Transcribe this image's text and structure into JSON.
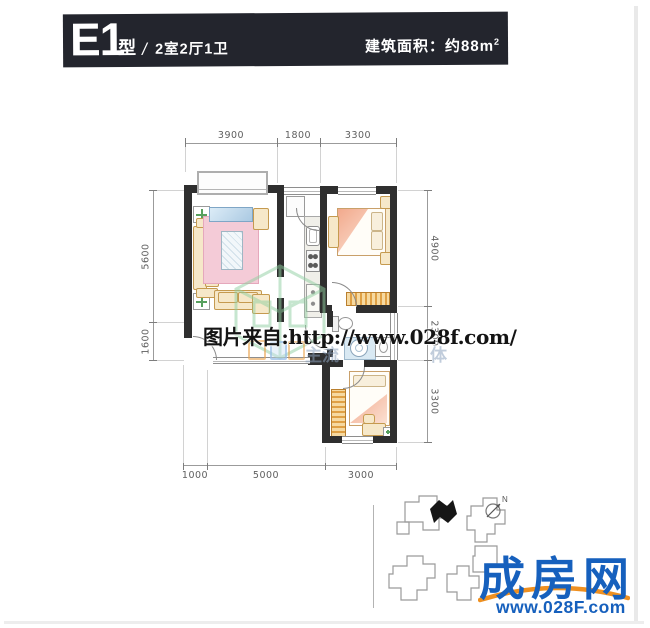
{
  "header": {
    "type_code": "E1",
    "type_word": "型",
    "slash": "/",
    "rooms": "2室2厅1卫",
    "area_label": "建筑面积：约88m",
    "area_exponent": "2"
  },
  "dimensions": {
    "top": [
      "3900",
      "1800",
      "3300"
    ],
    "left": [
      "5600",
      "1600"
    ],
    "right": [
      "4900",
      "2300",
      "3300"
    ],
    "bottom": [
      "1000",
      "5000",
      "3000"
    ]
  },
  "watermark": {
    "main": "图片来自:http://www.028f.com/",
    "faint_left": "主流",
    "faint_right": "体"
  },
  "compass": {
    "label": "N"
  },
  "branding": {
    "logo_text": "成房网",
    "site_url": "www.028F.com"
  },
  "colors": {
    "header_bg": "#23252d",
    "wall": "#2f2f2f",
    "logo_blue": "#1660bd",
    "swoosh_orange": "#ef9020",
    "watermark_green": "#8fcfa0",
    "rug_pink": "#f4cbd7",
    "furniture_tan": "#e8b96f"
  }
}
